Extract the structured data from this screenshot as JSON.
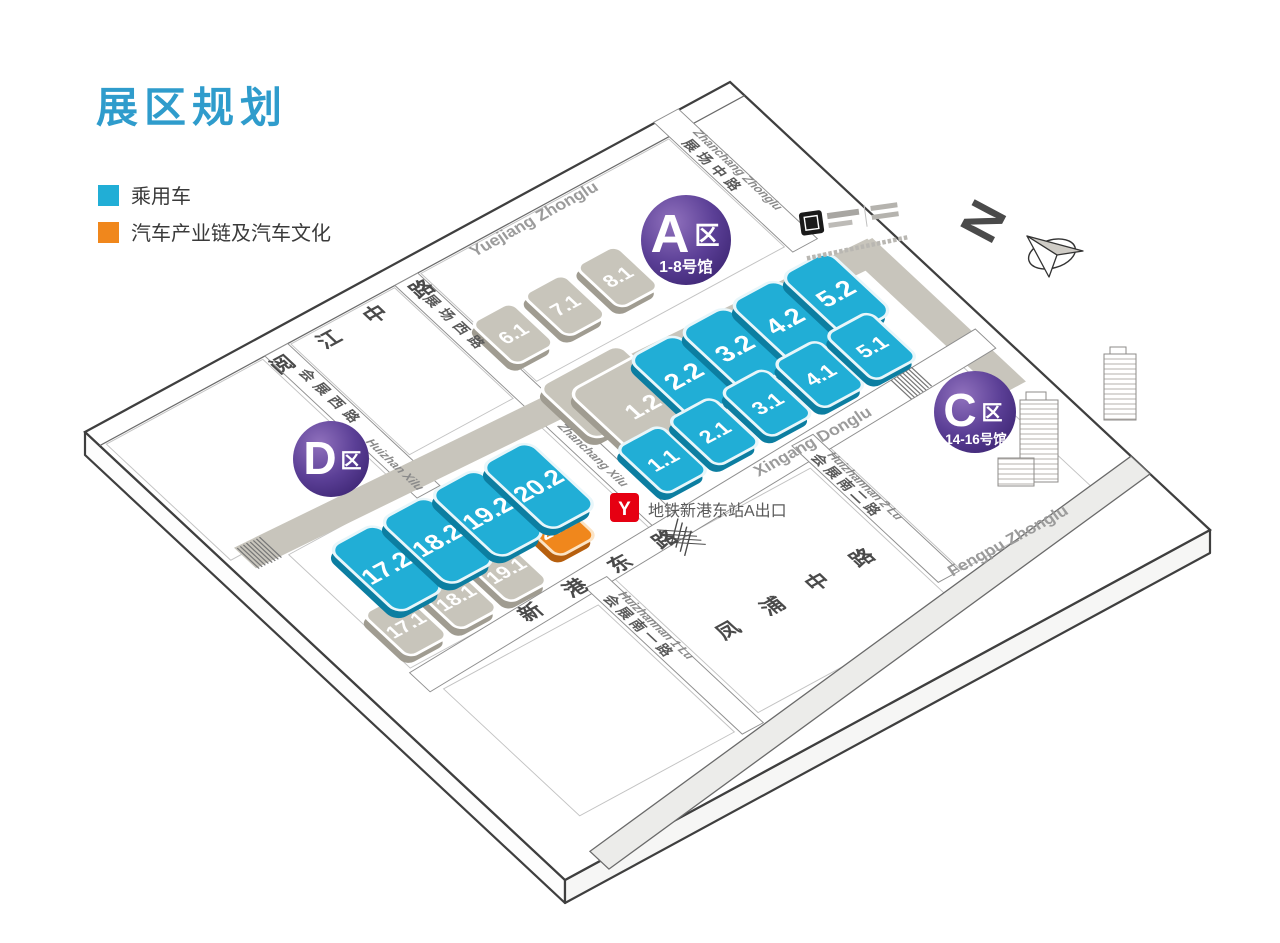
{
  "title": "展区规划",
  "legend": {
    "items": [
      {
        "label": "乘用车",
        "color": "#21aed6"
      },
      {
        "label": "汽车产业链及汽车文化",
        "color": "#f0871c"
      }
    ]
  },
  "zones": {
    "a": {
      "letter": "A",
      "qu": "区",
      "subtitle": "1-8号馆"
    },
    "c": {
      "letter": "C",
      "qu": "区",
      "subtitle": "14-16号馆"
    },
    "d": {
      "letter": "D",
      "qu": "区"
    }
  },
  "halls": {
    "h1_1": "1.1",
    "h2_1": "2.1",
    "h3_1": "3.1",
    "h4_1": "4.1",
    "h5_1": "5.1",
    "h2_2": "2.2",
    "h3_2": "3.2",
    "h4_2": "4.2",
    "h5_2": "5.2",
    "h1_2": "1.2",
    "h6_1": "6.1",
    "h7_1": "7.1",
    "h8_1": "8.1",
    "h17_2": "17.2",
    "h18_2": "18.2",
    "h19_2": "19.2",
    "h20_2": "20.2",
    "h17_1": "17.1",
    "h18_1": "18.1",
    "h19_1": "19.1",
    "h20_1": "20.1"
  },
  "roads": {
    "yuejiang_cn": "阅 江 中 路",
    "yuejiang_py": "Yuejiang Zhonglu",
    "zhanchang_zhong_cn": "展场中路",
    "zhanchang_zhong_py": "Zhanchang Zhonglu",
    "zhanchang_xi_cn": "展场西路",
    "zhanchang_xi_py": "Zhanchang Xilu",
    "huizhan_xi_cn": "会展西路",
    "huizhan_xi_py": "Huizhan Xilu",
    "xingang_cn": "新 港 东 路",
    "xingang_py": "Xingang Donglu",
    "huizhannan1_cn": "会展南一路",
    "huizhannan1_py": "Huizhannan 1 Lu",
    "huizhannan2_cn": "会展南二路",
    "huizhannan2_py": "Huizhannan 2 Lu",
    "fengpu_cn": "凤 浦 中 路",
    "fengpu_py": "Fengpu Zhonglu"
  },
  "metro": {
    "station_label": "地铁新港东站A出口"
  },
  "compass": {
    "north_label": "N"
  },
  "colors": {
    "title": "#2f9ccc",
    "passenger_blue": "#21aed6",
    "culture_orange": "#f0871c",
    "badge_purple_dark": "#3a2370",
    "metro_red": "#e60012"
  }
}
